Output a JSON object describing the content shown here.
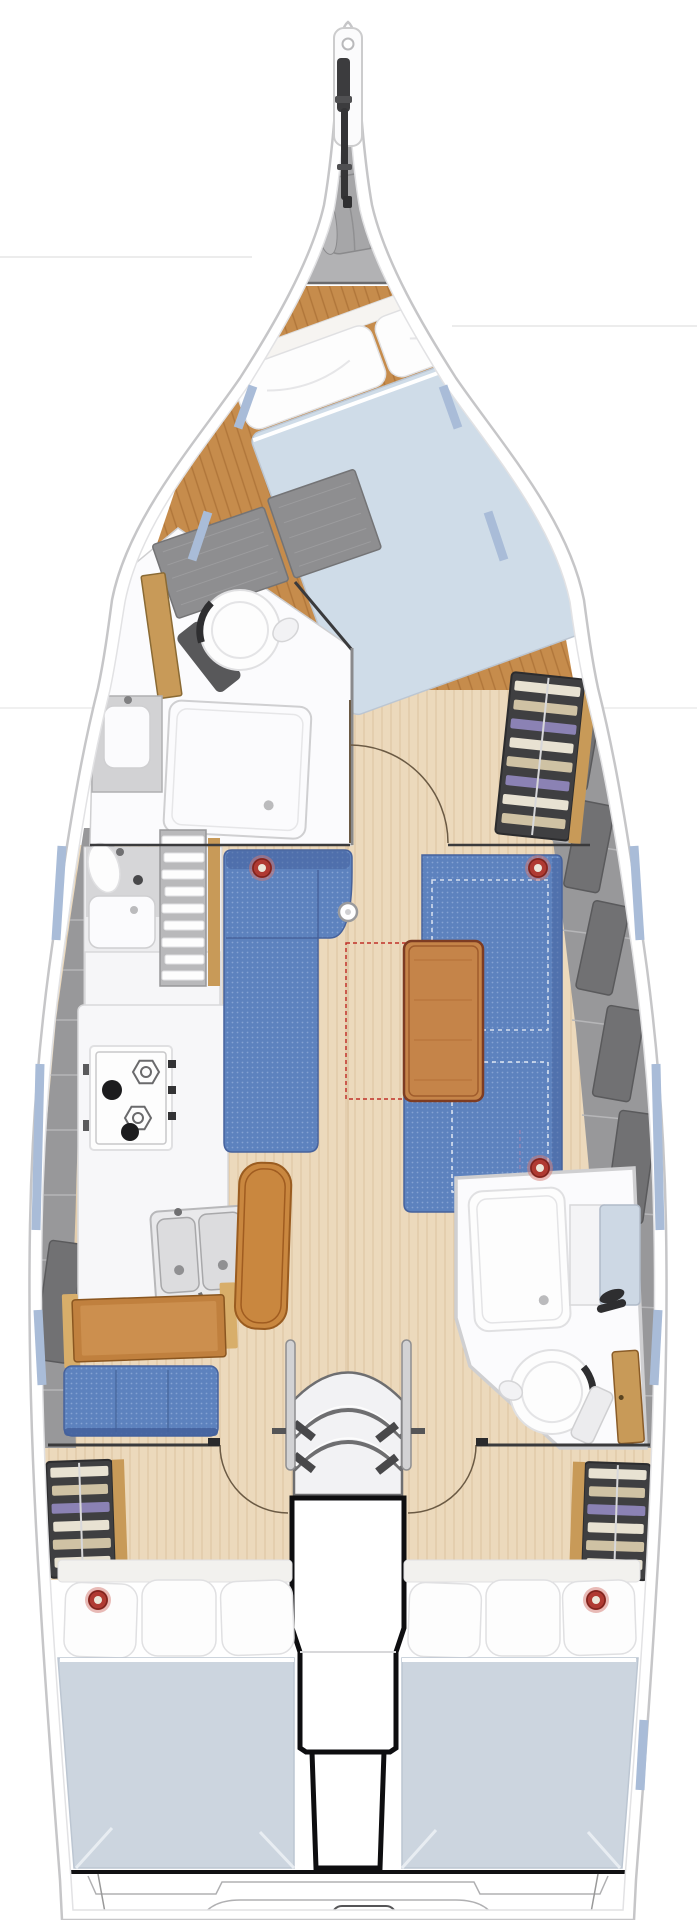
{
  "document": {
    "kind": "sailing-yacht-interior-floor-plan",
    "orientation": "bow-up",
    "visible_text": ""
  },
  "palette": {
    "hull_white": "#ffffff",
    "hull_stroke": "#c6c6c8",
    "rim_stroke": "#e2e2e4",
    "bg_line": "#ececec",
    "locker_gray": "#b2b2b4",
    "locker_gray_dark": "#a8a8aa",
    "bag_gray": "#a6a6a8",
    "bag_stroke": "#8a8a8c",
    "bag_cap": "#b8b8ba",
    "dark_fitting": "#3c3c3e",
    "wood_dark": "#c68c4c",
    "wood_dark_grain": "#b0763a",
    "wood_light": "#ecd9bc",
    "wood_light_grain": "#dcc4a0",
    "wood_mid": "#c89a58",
    "wood_trim": "#d8ae6a",
    "deck_gray": "#98989a",
    "deck_seam": "#b6b6b8",
    "panel_dark": "#717173",
    "panel_dark_edge": "#5a5a5c",
    "fixture_white": "#fbfbfd",
    "fixture_stroke": "#cfcfd1",
    "wall_dark": "#3a3a3c",
    "door_arc": "#6b5a44",
    "pillow_white": "#fdfdfd",
    "pillow_stroke": "#e0e0e2",
    "mattress_fwd": "#cfdce8",
    "mattress_aft": "#ccd5df",
    "mattress_edge": "#bcc6d2",
    "settee_blue": "#5d82be",
    "settee_dot": "#84a2d2",
    "settee_edge": "#47629c",
    "settee_dark": "#43609c",
    "table_wood": "#c58449",
    "table_edge": "#7e3c22",
    "bench_wood": "#c9873f",
    "bench_edge": "#9a5c20",
    "shelf_bg": "#3f3f41",
    "shelf_edge": "#2c2c2e",
    "shelf_cream": "#e8e2d2",
    "shelf_tan": "#cfc2a4",
    "shelf_purple": "#8b82b4",
    "ring_red": "#b03a32",
    "ring_halo": "#d4776f",
    "ring_center": "#ece7da",
    "ring_dark": "#7e241e",
    "hull_blue": "#a9bcd8",
    "accent_red": "#c03028",
    "metal_gray": "#dcdcde",
    "metal_edge": "#a8a8aa",
    "burner_black": "#1c1c1e",
    "steps_light": "#f2f2f4",
    "steps_edge": "#6e6e70",
    "engine_outline": "#0e0e10",
    "headboard": "#f2f1ee",
    "vanity_blue": "#cdd8e4",
    "vanity_edge": "#b0bac8"
  },
  "components": {
    "bow": [
      "bowsprit",
      "anchor-roller",
      "anchor-locker",
      "sail-bag"
    ],
    "forward_cabin": [
      "double-berth",
      "pillows",
      "wood-floor",
      "hanging-lockers"
    ],
    "forward_head": [
      "toilet",
      "vanity-sink",
      "shower-pan",
      "louvered-locker",
      "wash-basin"
    ],
    "salon": [
      "port-l-settee",
      "starboard-u-settee",
      "dining-table",
      "center-bench",
      "mast-post",
      "clothes-shelf-unit",
      "table-extension-dashed-outline"
    ],
    "galley": [
      "gimbaled-stove-4-burners",
      "double-sink",
      "counter"
    ],
    "nav_station": [
      "chart-desk",
      "nav-seat"
    ],
    "aft_head": [
      "toilet",
      "shower-pan",
      "vanity-sink",
      "wood-door"
    ],
    "companionway": [
      "three-curved-steps",
      "side-rails",
      "engine-box"
    ],
    "aft_cabins": [
      "port-double-berth",
      "starboard-double-berth",
      "pillows",
      "clothes-shelves"
    ],
    "stern": [
      "transom-platform-outlines"
    ]
  },
  "counts": {
    "red_ring_markers": 5,
    "cabins": 3,
    "heads": 2,
    "companionway_steps": 3,
    "stove_burners": 4,
    "aft_pillows_per_bed": 3
  }
}
